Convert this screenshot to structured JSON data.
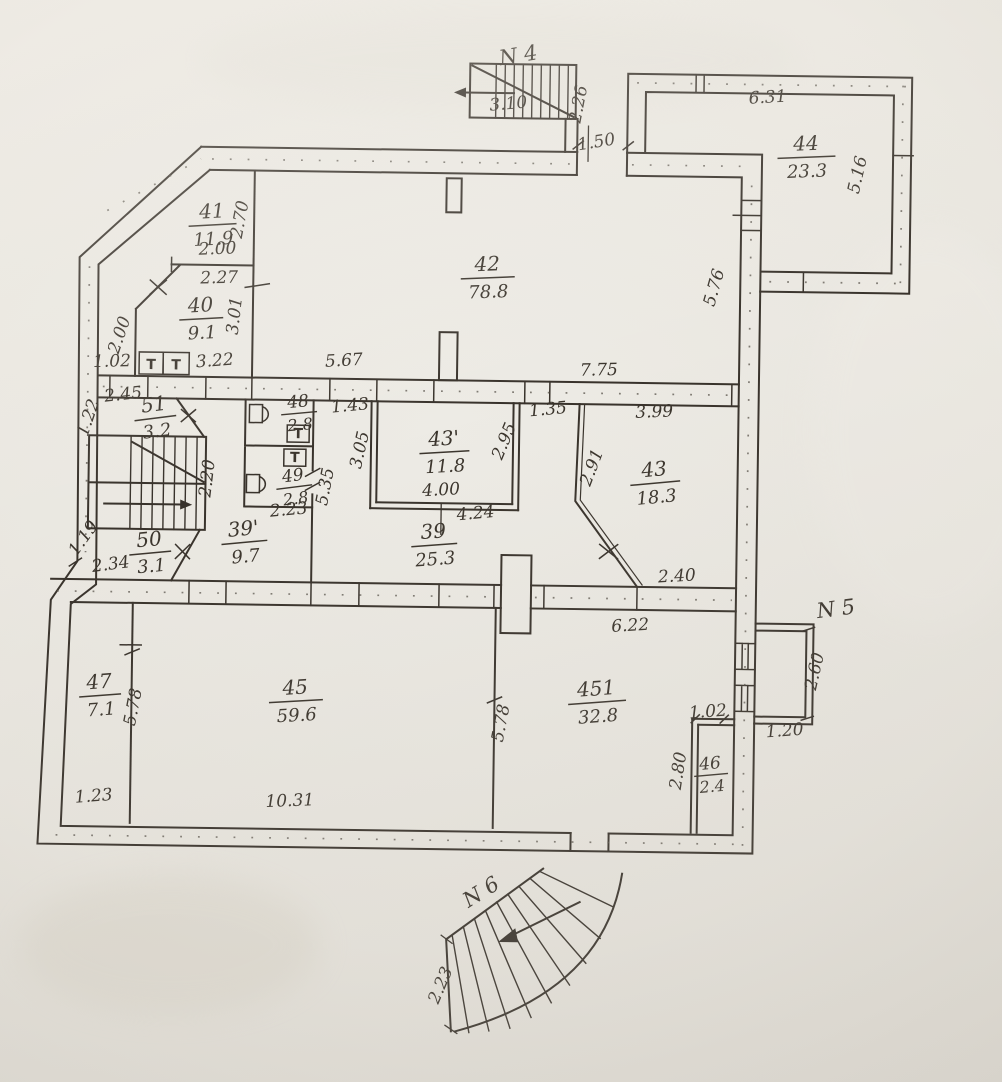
{
  "plan": {
    "stair_labels": {
      "n4": "N 4",
      "n5": "N 5",
      "n6": "N 6"
    },
    "fixture_sink_symbol": "T",
    "rooms": {
      "r41": {
        "num": "41",
        "area": "11.9"
      },
      "r40": {
        "num": "40",
        "area": "9.1"
      },
      "r42": {
        "num": "42",
        "area": "78.8"
      },
      "r44": {
        "num": "44",
        "area": "23.3"
      },
      "r51": {
        "num": "51",
        "area": "3.2"
      },
      "r48": {
        "num": "48",
        "area": "2.8"
      },
      "r49": {
        "num": "49",
        "area": "2.8"
      },
      "r43a": {
        "num": "43'",
        "area": "11.8"
      },
      "r43": {
        "num": "43",
        "area": "18.3"
      },
      "r50": {
        "num": "50",
        "area": "3.1"
      },
      "r39a": {
        "num": "39'",
        "area": "9.7"
      },
      "r39": {
        "num": "39",
        "area": "25.3"
      },
      "r47": {
        "num": "47",
        "area": "7.1"
      },
      "r45": {
        "num": "45",
        "area": "59.6"
      },
      "r45a": {
        "num": "451",
        "area": "32.8"
      },
      "r46": {
        "num": "46",
        "area": "2.4"
      }
    },
    "dims": {
      "n4_width": "3.10",
      "n4_depth": "2.26",
      "entry_width": "1.50",
      "annex_width": "6.31",
      "annex_depth": "5.16",
      "r42_right": "5.76",
      "r41_right": "2.70",
      "r41_width": "2.00",
      "r40_width": "2.27",
      "r40_right": "3.01",
      "r40_left": "2.00",
      "cor1_a": "1.02",
      "cor1_b": "3.22",
      "cor1_c": "5.67",
      "cor1_d": "7.75",
      "r51_width": "2.45",
      "r51_left": "1.22",
      "door43a": "1.43",
      "cor1_e": "1.35",
      "r43_top": "3.99",
      "r43a_left": "3.05",
      "r43a_right": "2.95",
      "r43_diag": "2.91",
      "stair_width": "2.20",
      "wc_width": "2.23",
      "wall39_len": "5.35",
      "r43a_in": "4.00",
      "r43a_out": "4.24",
      "jog_a": "1.19",
      "jog_b": "2.34",
      "r43_bottom": "2.40",
      "cor2_width": "6.22",
      "porch_depth": "2.60",
      "porch_width": "1.20",
      "r47_right": "5.78",
      "r45_right": "5.78",
      "r46_width": "1.02",
      "r46_depth": "2.80",
      "r47_bottom": "1.23",
      "r45_bottom": "10.31",
      "n6_width": "2.23"
    }
  }
}
